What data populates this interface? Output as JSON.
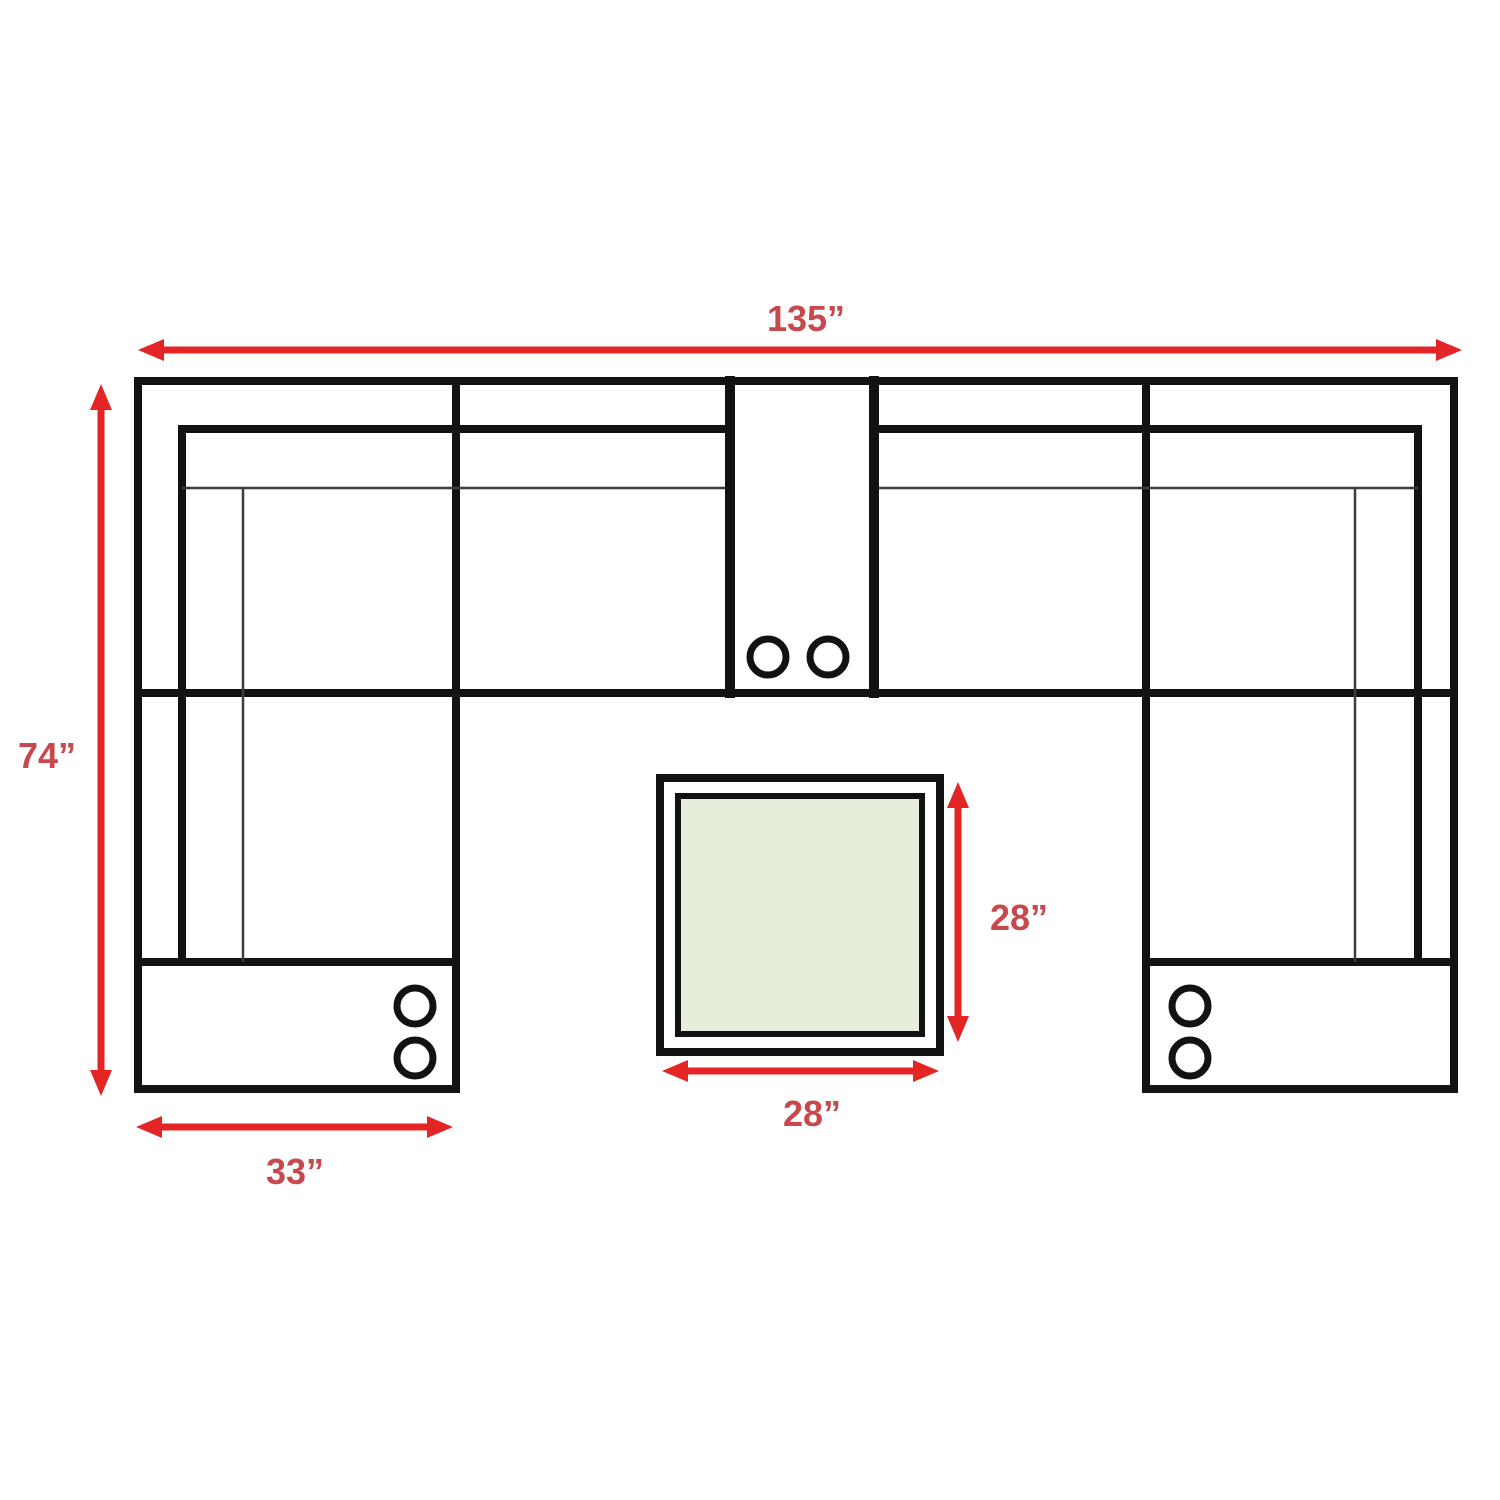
{
  "diagram": {
    "kind": "sectional-sofa-dimension-diagram",
    "dimensions": {
      "overall_width": "135”",
      "overall_depth": "74”",
      "chaise_width": "33”",
      "ottoman_depth": "28”",
      "ottoman_width": "28”"
    },
    "icons": {
      "cup_holder": "cup-holder-circle"
    }
  },
  "colors": {
    "accent_red": "#e32526",
    "label_red": "#c7494e",
    "line_black": "#121212",
    "line_thin": "#3d3d3d",
    "ottoman_fill": "#e6eedb",
    "background": "#ffffff"
  }
}
